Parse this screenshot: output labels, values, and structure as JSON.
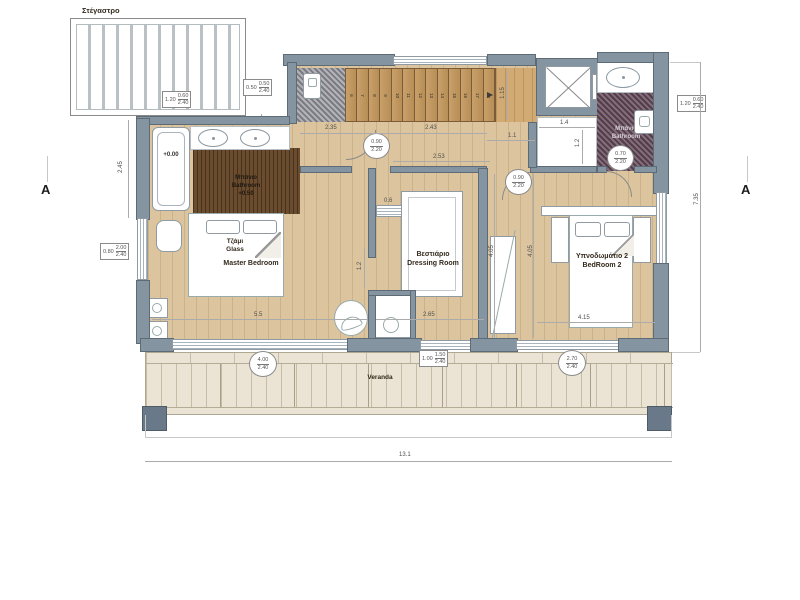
{
  "drawing": {
    "pergola_label": "Στέγαστρο",
    "section_marker": "A",
    "level_main": "+0.00",
    "rooms": {
      "master_bedroom": "Master Bedroom",
      "glass_line1": "Τζάμι",
      "glass_line2": "Glass",
      "master_bath_line1": "Μπάνιο",
      "master_bath_line2": "Bathroom",
      "master_bath_level": "+0.50",
      "dressing_line1": "Βεστιάριο",
      "dressing_line2": "Dressing Room",
      "bedroom2_line1": "Υπνοδωμάτιο 2",
      "bedroom2_line2": "BedRoom 2",
      "bath2_line1": "Μπάνιο",
      "bath2_line2": "Bathroom",
      "veranda": "Veranda"
    },
    "stairs": {
      "numbers": [
        "6",
        "7",
        "8",
        "9",
        "10",
        "11",
        "12",
        "13",
        "14",
        "15",
        "16",
        "17",
        "18"
      ]
    },
    "dims": {
      "left_height": "2.45",
      "hall_w1": "2.35",
      "hall_w2": "2.43",
      "hall_w3": "1.1",
      "dressing_top": "2.53",
      "shelf": "0.6",
      "dressing_left": "1.2",
      "dressing_bottom": "2.65",
      "dressing_h": "4.05",
      "bedroom2_h": "4.05",
      "bedroom2_w": "4.15",
      "master_w": "5.5",
      "hall_e_w": "1.4",
      "hall_e_h": "1.2",
      "stair_landing": "1.15",
      "total_w": "13.1",
      "total_h": "7.35"
    },
    "dim_boxes": {
      "pergola": {
        "left": "1.20",
        "num": "0.60",
        "den": "2.40"
      },
      "top": {
        "left": "0.50",
        "num": "0.50",
        "den": "2.40"
      },
      "right": {
        "left": "1.20",
        "num": "0.60",
        "den": "2.40"
      },
      "left": {
        "left": "0.80",
        "num": "2.00",
        "den": "2.40"
      },
      "veranda": {
        "left": "1.00",
        "num": "1.50",
        "den": "2.40"
      }
    },
    "dim_circles": {
      "door_master": {
        "top": "0.90",
        "bottom": "2.20"
      },
      "door_bedroom2": {
        "top": "0.90",
        "bottom": "2.20"
      },
      "door_bath2": {
        "top": "0.70",
        "bottom": "2.20"
      },
      "window_master": {
        "top": "4.00",
        "bottom": "2.40"
      },
      "window_bedroom2": {
        "top": "2.70",
        "bottom": "2.40"
      }
    },
    "colors": {
      "wall": "#8495a1",
      "light_wood": "#dcc59e",
      "dark_wood": "#6b4c2f",
      "purple_mosaic": "#6e5263",
      "gray_mosaic": "#9a9aa2",
      "veranda_tile": "#ebe4d4"
    }
  }
}
